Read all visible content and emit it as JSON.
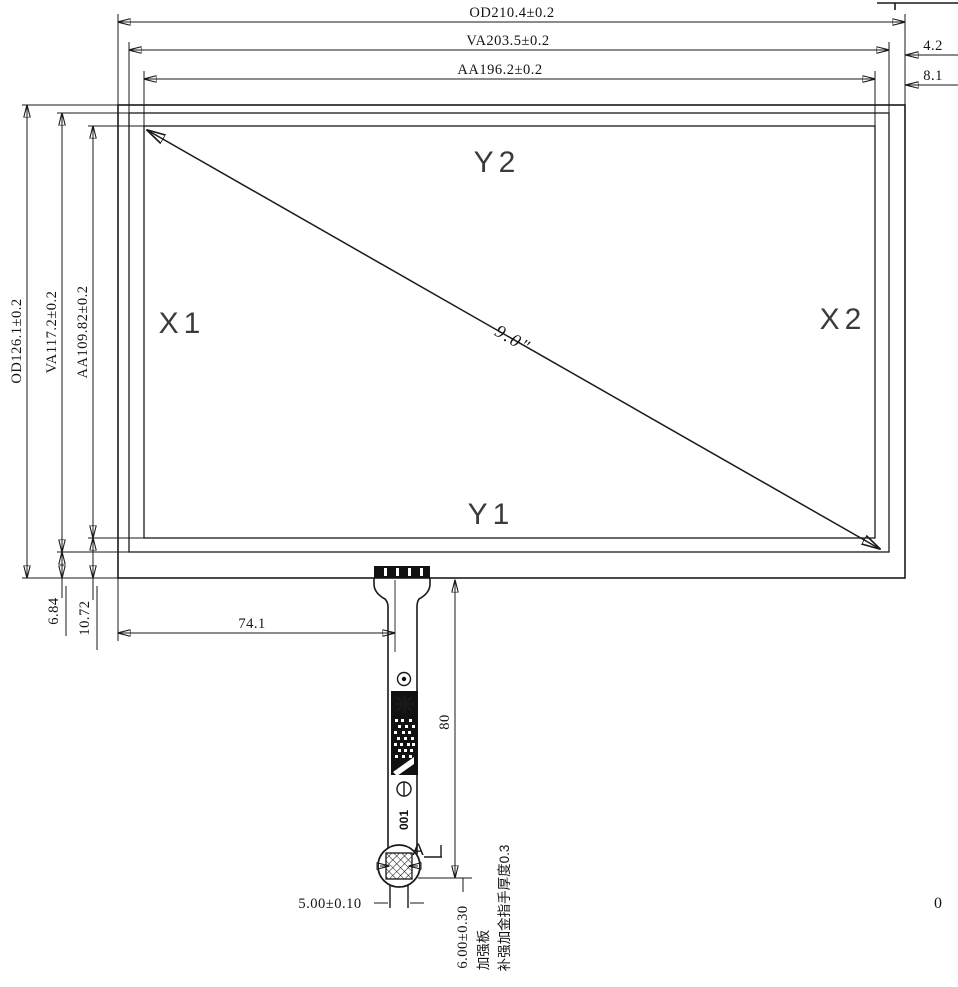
{
  "dims": {
    "od_width": "OD210.4±0.2",
    "va_width": "VA203.5±0.2",
    "aa_width": "AA196.2±0.2",
    "va_right_gap": "4.2",
    "aa_right_gap": "8.1",
    "od_height": "OD126.1±0.2",
    "va_height": "VA117.2±0.2",
    "aa_height": "AA109.82±0.2",
    "va_bottom_gap": "6.84",
    "aa_bottom_gap": "10.72",
    "tail_center_offset": "74.1",
    "tail_length": "80",
    "tail_width": "5.00±0.10",
    "stiffener_width": "6.00±0.30",
    "diagonal_size": "9.0\""
  },
  "labels": {
    "top_electrode": "Y2",
    "bottom_electrode": "Y1",
    "left_electrode": "X1",
    "right_electrode": "X2"
  },
  "annotations": {
    "detail_marker": "A",
    "fpc_serial": "001",
    "note_stiffener": "加强板",
    "note_gold_finger": "补强加金指手厚度0.3",
    "corner_text": "0"
  }
}
